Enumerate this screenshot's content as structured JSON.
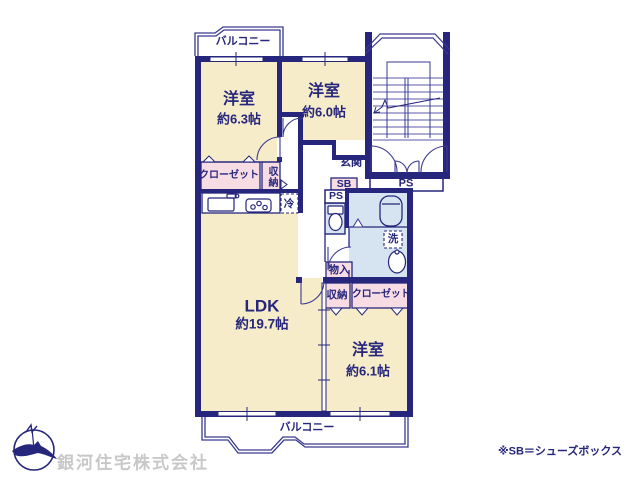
{
  "floorplan": {
    "balcony_top": "バルコニー",
    "balcony_bottom": "バルコニー",
    "rooms": {
      "bedroom1": {
        "name": "洋室",
        "size": "約6.3帖"
      },
      "bedroom2": {
        "name": "洋室",
        "size": "約6.0帖"
      },
      "bedroom3": {
        "name": "洋室",
        "size": "約6.1帖"
      },
      "ldk": {
        "name": "LDK",
        "size": "約19.7帖"
      }
    },
    "features": {
      "genkan": "玄関",
      "sb": "SB",
      "ps_meter": "PS",
      "ps_pipe": "PS",
      "closet_top": "クローゼット",
      "closet_bottom": "クローゼット",
      "storage_top": "収納",
      "storage_bottom": "収納",
      "storage_small": "物入",
      "fridge": "冷",
      "laundry": "洗"
    },
    "colors": {
      "wall": "#26267c",
      "room_fill": "#f6ecca",
      "closet_fill": "#f8dce4",
      "wet_area_fill": "#d6e4f2",
      "company_text": "#c8c8c8"
    }
  },
  "footer": {
    "note": "※SB＝シューズボックス",
    "company": "銀河住宅株式会社"
  }
}
